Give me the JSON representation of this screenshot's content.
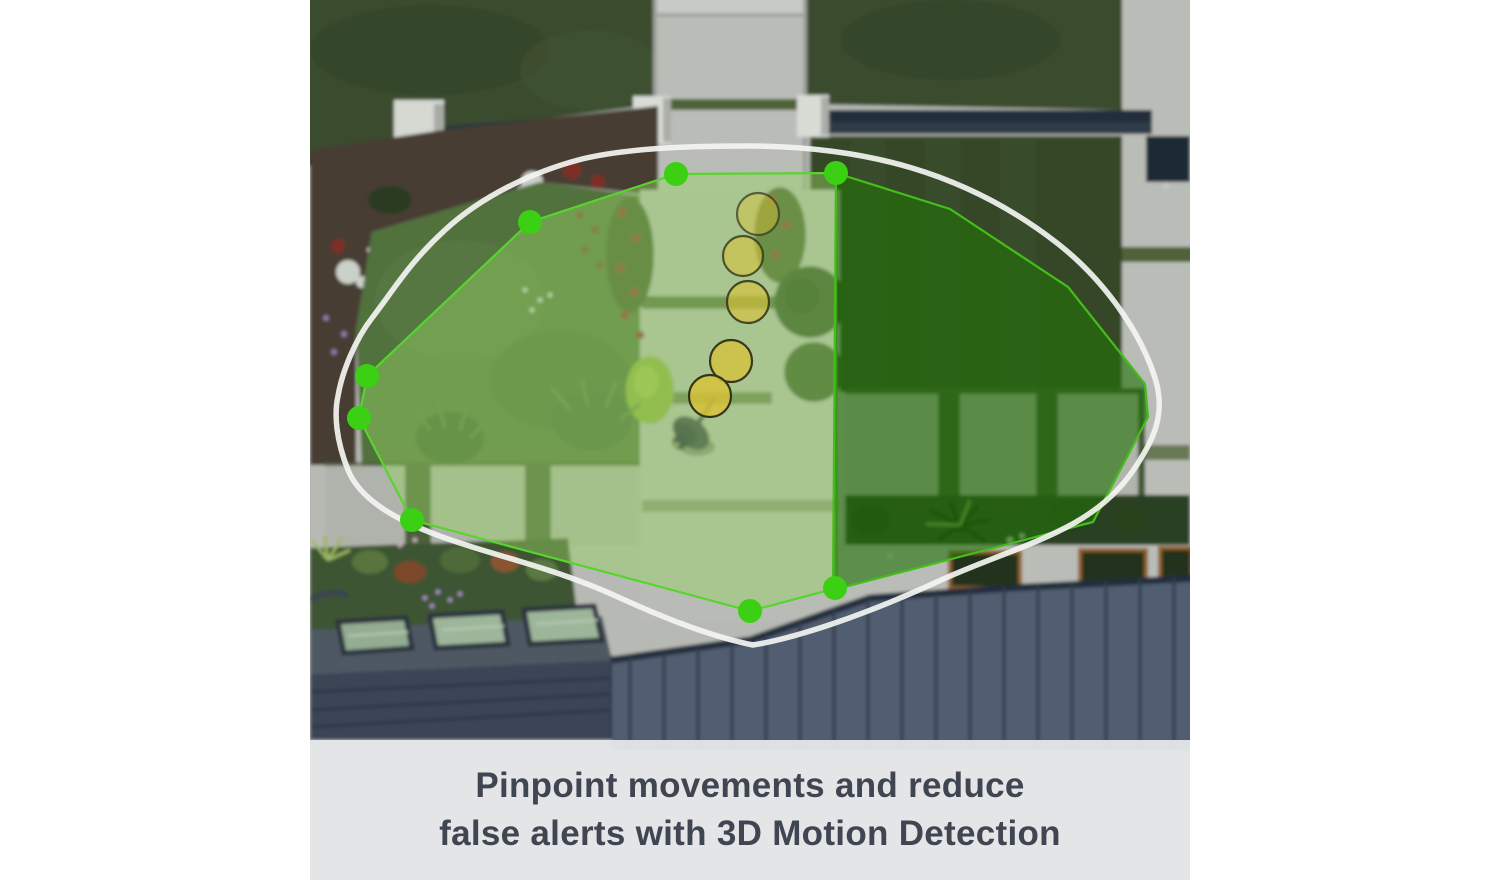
{
  "caption": {
    "line1": "Pinpoint movements and reduce",
    "line2": "false alerts with 3D Motion Detection",
    "text_color": "#3f4551",
    "band_color": "rgba(229,231,234,0.95)"
  },
  "overlay": {
    "boundary": {
      "path": "M440,146 C495,146 552,153 602,168 C652,183 702,208 747,243 C792,278 830,330 845,378 C852,400 851,422 838,446 C820,480 798,506 755,528 C712,550 668,562 618,586 C560,612 492,637 443,645 C398,636 350,616 308,597 C262,576 225,566 172,550 C120,534 55,512 38,470 C26,440 24,414 28,396 C32,372 45,340 62,318 C85,288 100,262 135,230 C172,196 222,172 272,159 C322,147 390,146 440,146 Z",
      "color": "#f4f5f2",
      "width": 5.5,
      "opacity": 0.92
    },
    "zones": [
      {
        "id": "detection-zone-left",
        "points": [
          [
            366,
            174
          ],
          [
            526,
            173
          ],
          [
            527,
            588
          ],
          [
            440,
            611
          ],
          [
            102,
            520
          ],
          [
            49,
            418
          ],
          [
            57,
            376
          ],
          [
            220,
            222
          ]
        ],
        "fill": "rgba(150,210,100,0.45)",
        "stroke": "#58d42e"
      },
      {
        "id": "detection-zone-right",
        "points": [
          [
            526,
            173
          ],
          [
            640,
            209
          ],
          [
            758,
            287
          ],
          [
            835,
            384
          ],
          [
            838,
            417
          ],
          [
            783,
            522
          ],
          [
            523,
            590
          ]
        ],
        "fill": "rgba(35,115,10,0.62)",
        "stroke": "#45bd1c"
      }
    ],
    "vertex_dots": {
      "color": "#3bd014",
      "radius": 12,
      "points": [
        [
          366,
          174
        ],
        [
          526,
          173
        ],
        [
          220,
          222
        ],
        [
          57,
          376
        ],
        [
          49,
          418
        ],
        [
          102,
          520
        ],
        [
          440,
          611
        ],
        [
          525,
          588
        ]
      ]
    },
    "motion_trail": {
      "fill": "#d9c235",
      "stroke": "#33331a",
      "circles": [
        {
          "x": 448,
          "y": 214,
          "r": 21,
          "opacity": 0.45
        },
        {
          "x": 433,
          "y": 256,
          "r": 20,
          "opacity": 0.55
        },
        {
          "x": 438,
          "y": 302,
          "r": 21,
          "opacity": 0.62
        },
        {
          "x": 421,
          "y": 361,
          "r": 21,
          "opacity": 0.72
        },
        {
          "x": 400,
          "y": 396,
          "r": 21,
          "opacity": 0.8
        }
      ]
    }
  }
}
